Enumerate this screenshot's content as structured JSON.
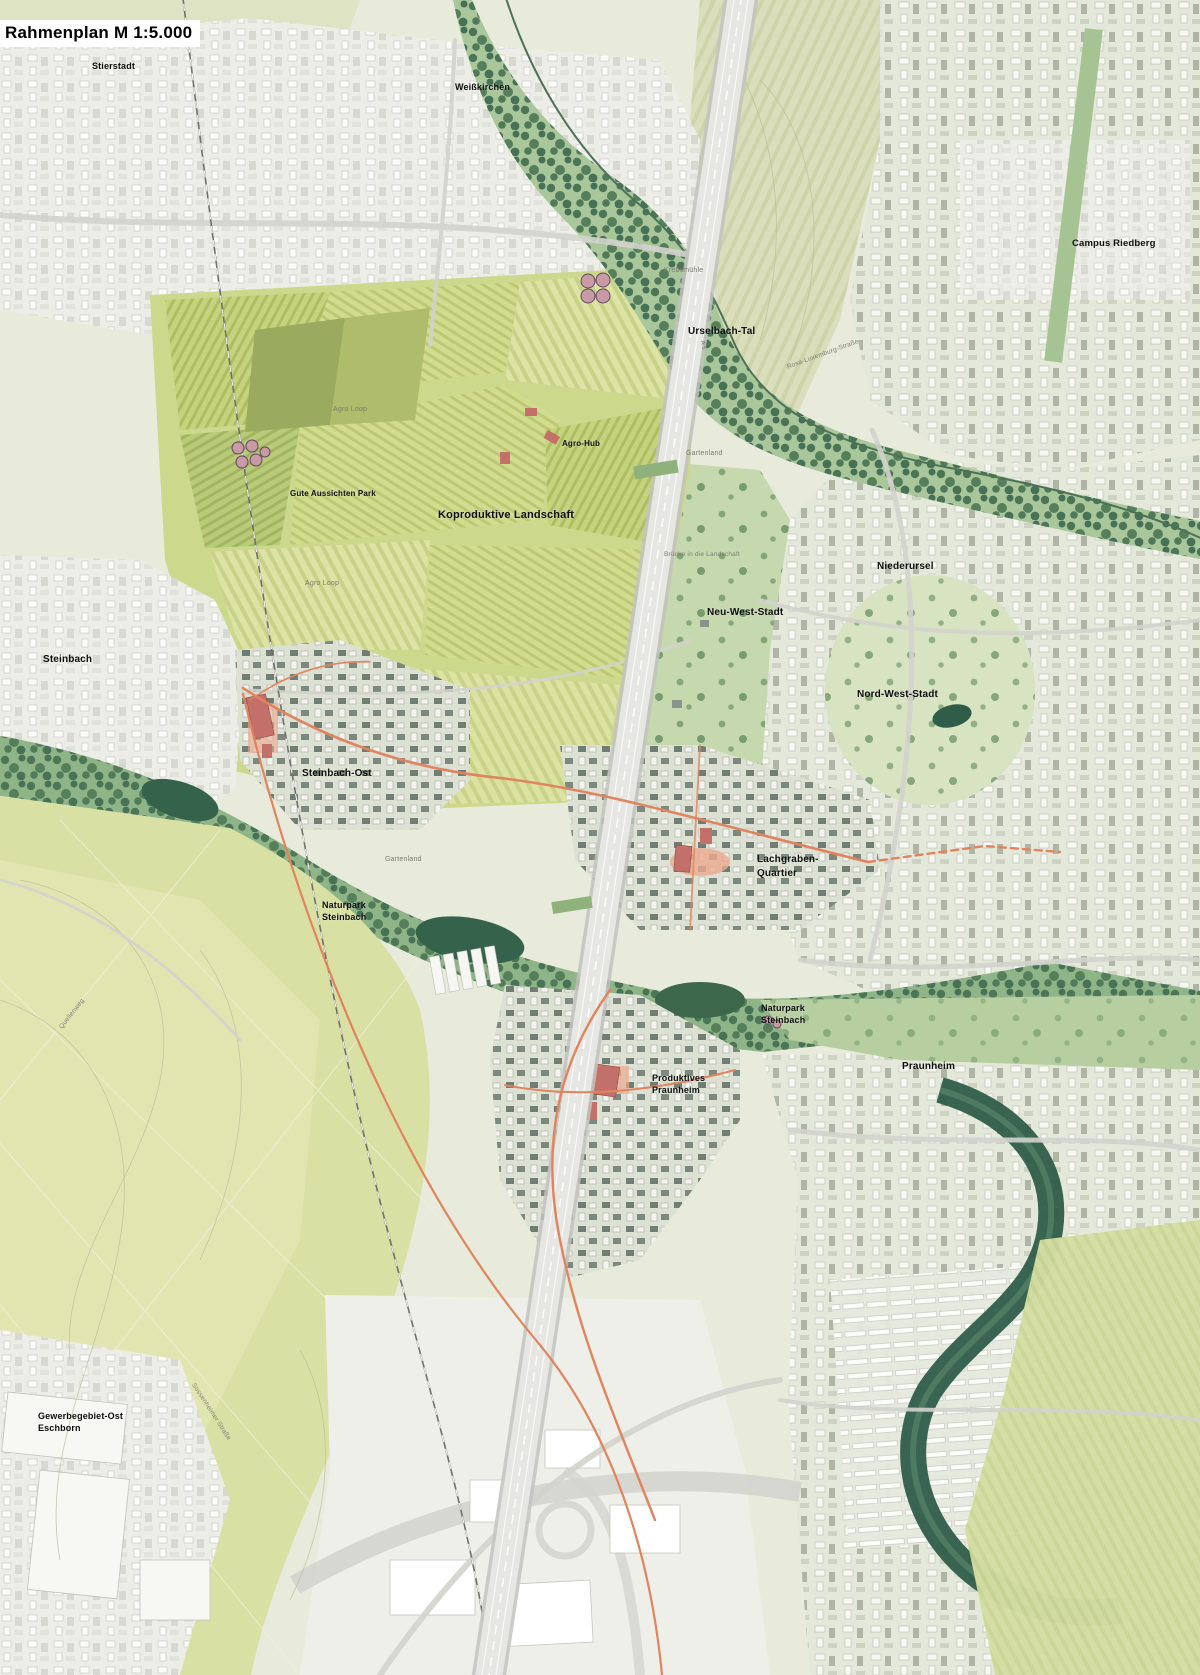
{
  "title": "Rahmenplan M 1:5.000",
  "map": {
    "colors": {
      "background": "#e8ebdb",
      "field_green": "#ccd88c",
      "meadow_green": "#d9e0a4",
      "corridor_green": "#9dbd92",
      "forest_green": "#3c674a",
      "urban_white": "#f0f0ea",
      "urban_sage": "#e4e8da",
      "highway_gray": "#e6e6e2",
      "accent_orange": "#e0845f",
      "accent_red": "#c4706a",
      "water_dark": "#2f5d49",
      "label_black": "#0d0d0d",
      "label_gray": "#787d70"
    },
    "labels": [
      {
        "id": "stierstadt",
        "text": "Stierstadt",
        "x": 92,
        "y": 60,
        "size": 9,
        "tone": "primary"
      },
      {
        "id": "weisskirchen",
        "text": "Weißkirchen",
        "x": 455,
        "y": 81,
        "size": 9,
        "tone": "primary"
      },
      {
        "id": "campus-riedberg",
        "text": "Campus Riedberg",
        "x": 1072,
        "y": 238,
        "size": 9.5,
        "tone": "primary"
      },
      {
        "id": "urselbach-tal",
        "text": "Urselbach-Tal",
        "x": 688,
        "y": 325,
        "size": 10,
        "tone": "primary"
      },
      {
        "id": "agro-hub",
        "text": "Agro-Hub",
        "x": 562,
        "y": 439,
        "size": 8,
        "tone": "primary"
      },
      {
        "id": "gute-aussichten-park",
        "text": "Gute Aussichten Park",
        "x": 290,
        "y": 489,
        "size": 8,
        "tone": "primary"
      },
      {
        "id": "koproduktive-landschaft",
        "text": "Koproduktive Landschaft",
        "x": 438,
        "y": 508,
        "size": 11,
        "tone": "primary"
      },
      {
        "id": "niederursel",
        "text": "Niederursel",
        "x": 877,
        "y": 560,
        "size": 10,
        "tone": "primary"
      },
      {
        "id": "neu-west-stadt",
        "text": "Neu-West-Stadt",
        "x": 707,
        "y": 606,
        "size": 10,
        "tone": "primary"
      },
      {
        "id": "nord-west-stadt",
        "text": "Nord-West-Stadt",
        "x": 857,
        "y": 688,
        "size": 10,
        "tone": "primary"
      },
      {
        "id": "steinbach",
        "text": "Steinbach",
        "x": 43,
        "y": 653,
        "size": 10,
        "tone": "primary"
      },
      {
        "id": "steinbach-ost",
        "text": "Steinbach-Ost",
        "x": 302,
        "y": 767,
        "size": 10,
        "tone": "primary"
      },
      {
        "id": "naturpark-steinbach-west",
        "text": "Naturpark\nSteinbach",
        "x": 322,
        "y": 899,
        "size": 9,
        "tone": "primary"
      },
      {
        "id": "lachgraben-quartier",
        "text": "Lachgraben-\nQuartier",
        "x": 757,
        "y": 853,
        "size": 10,
        "tone": "primary"
      },
      {
        "id": "naturpark-steinbach-ost",
        "text": "Naturpark\nSteinbach",
        "x": 761,
        "y": 1002,
        "size": 9,
        "tone": "primary"
      },
      {
        "id": "produktives-praunheim",
        "text": "Produktives\nPraunheim",
        "x": 652,
        "y": 1072,
        "size": 9,
        "tone": "primary"
      },
      {
        "id": "praunheim",
        "text": "Praunheim",
        "x": 902,
        "y": 1060,
        "size": 10,
        "tone": "primary"
      },
      {
        "id": "gewerbegebiet-ost-eschborn",
        "text": "Gewerbegebiet-Ost\nEschborn",
        "x": 38,
        "y": 1410,
        "size": 9,
        "tone": "primary"
      },
      {
        "id": "krebsmuehle",
        "text": "Krebsmühle",
        "x": 664,
        "y": 266,
        "size": 7,
        "tone": "minor"
      },
      {
        "id": "agro-loop-nord",
        "text": "Agro Loop",
        "x": 333,
        "y": 405,
        "size": 7,
        "tone": "minor"
      },
      {
        "id": "agro-loop-sued",
        "text": "Agro Loop",
        "x": 305,
        "y": 579,
        "size": 7,
        "tone": "minor"
      },
      {
        "id": "gartenland-ost",
        "text": "Gartenland",
        "x": 686,
        "y": 449,
        "size": 7,
        "tone": "minor"
      },
      {
        "id": "gartenland-west",
        "text": "Gartenland",
        "x": 385,
        "y": 855,
        "size": 7,
        "tone": "minor"
      },
      {
        "id": "bruecke-landschaft",
        "text": "Brücke in die Landschaft",
        "x": 664,
        "y": 551,
        "size": 6.5,
        "tone": "minor"
      },
      {
        "id": "rosa-luxemburg-strasse",
        "text": "Rosa-Luxemburg-Straße",
        "x": 786,
        "y": 364,
        "size": 6.5,
        "tone": "minor",
        "rot": -20
      },
      {
        "id": "sossenheimer-strasse",
        "text": "Sossenheimer Straße",
        "x": 196,
        "y": 1382,
        "size": 6.5,
        "tone": "minor",
        "rot": 57
      },
      {
        "id": "quellenweg",
        "text": "Quellenweg",
        "x": 58,
        "y": 1026,
        "size": 6.5,
        "tone": "minor",
        "rot": -52
      },
      {
        "id": "autobahn-a5-marker",
        "text": "A 5",
        "x": 706,
        "y": 340,
        "size": 6,
        "tone": "minor",
        "rot": 82
      }
    ]
  }
}
